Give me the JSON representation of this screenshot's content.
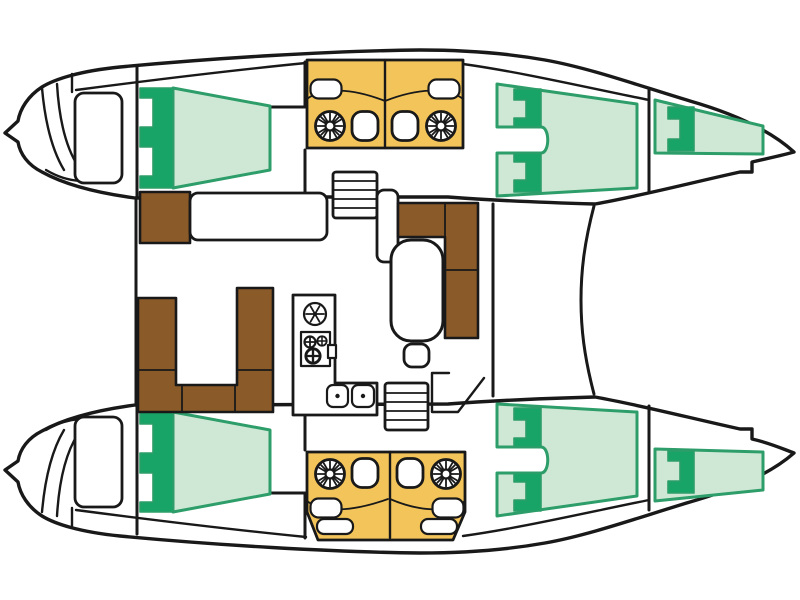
{
  "diagram": {
    "type": "catamaran-floor-plan",
    "view": "top-down deck layout",
    "orientation": {
      "bow": "right",
      "stern": "left"
    },
    "port_hull": {
      "aft_cabin": "double-berth",
      "head": [
        "shower",
        "toilet",
        "sink"
      ],
      "forward_cabin": "double-berth",
      "bow_compartment": "single-berth",
      "transom": "swim-platform-with-steps"
    },
    "starboard_hull": {
      "aft_cabin": "double-berth",
      "head": [
        "shower",
        "toilet",
        "sink",
        "seat"
      ],
      "forward_cabin": "double-berth",
      "bow_compartment": "single-berth",
      "transom": "swim-platform-with-steps"
    },
    "bridgedeck": {
      "cockpit": [
        "u-shaped-settee",
        "aft-bench",
        "helm-seat"
      ],
      "saloon": [
        "l-shaped-settee",
        "dining-table",
        "stool",
        "chart-counter"
      ],
      "galley": [
        "vent-fan",
        "three-burner-stove",
        "double-sink"
      ],
      "stairs": [
        "port-companionway",
        "starboard-companionway"
      ],
      "foredeck": "trampoline-area"
    }
  },
  "icons": {
    "shower": "circle-with-radial-jets",
    "toilet": "rounded-bowl",
    "sink": "rounded-rectangle-basin",
    "stove": "square-with-burner-crosses",
    "fan": "circle-with-spokes",
    "stairs": "striped-ladder-rectangle"
  },
  "colors": {
    "line": "#191919",
    "hull_fill": "#ffffff",
    "berth_light": "#cfe8d5",
    "berth_dark": "#18a367",
    "berth_border": "#2d9d69",
    "bathroom_yellow": "#f3c45a",
    "wood_brown": "#8a5a28",
    "fixture_white": "#ffffff"
  }
}
